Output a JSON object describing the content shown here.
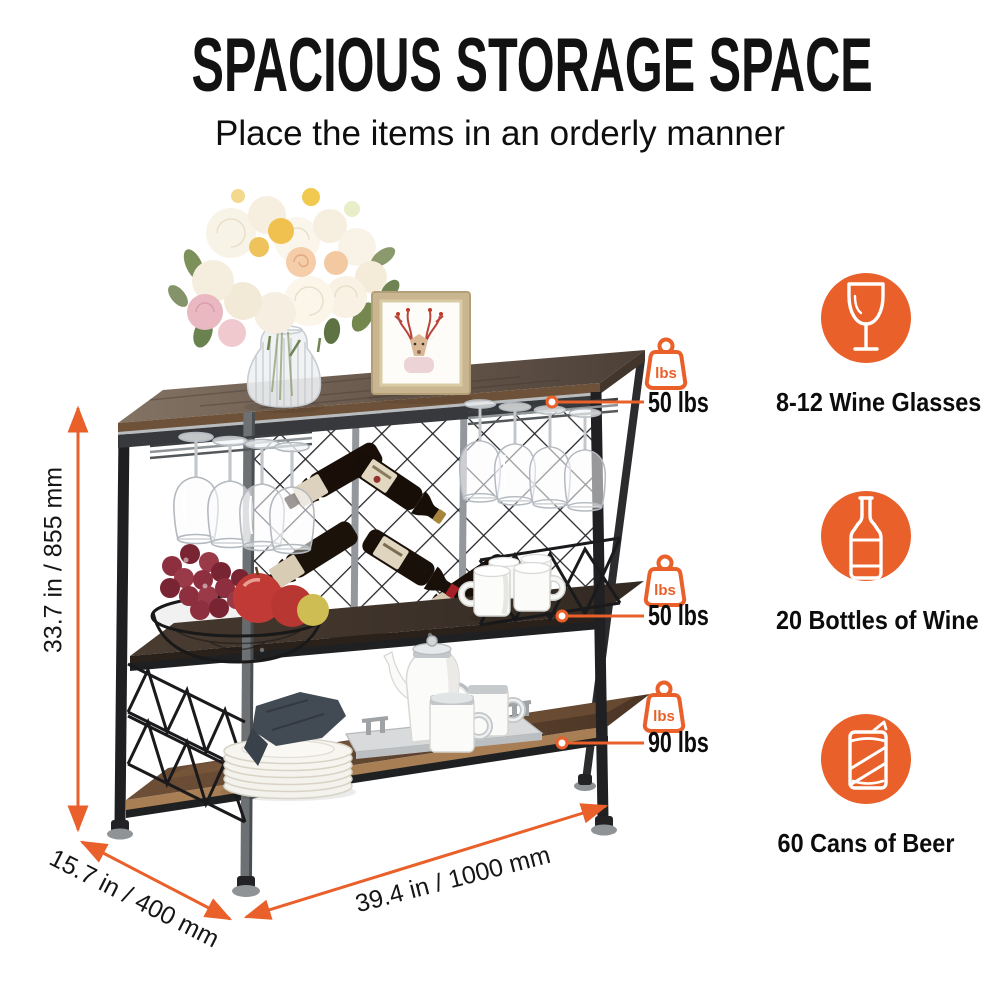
{
  "header": {
    "title": "SPACIOUS STORAGE SPACE",
    "subtitle": "Place the items in an orderly manner"
  },
  "dimensions": {
    "height": "33.7 in / 855 mm",
    "depth": "15.7 in / 400 mm",
    "width": "39.4 in / 1000 mm"
  },
  "capacity_callouts": [
    {
      "icon": "weight-lbs-icon",
      "icon_text": "lbs",
      "label": "50 lbs"
    },
    {
      "icon": "weight-lbs-icon",
      "icon_text": "lbs",
      "label": "50 lbs"
    },
    {
      "icon": "weight-lbs-icon",
      "icon_text": "lbs",
      "label": "90 lbs"
    }
  ],
  "features": [
    {
      "icon": "wine-glass-icon",
      "label": "8-12 Wine Glasses"
    },
    {
      "icon": "wine-bottle-icon",
      "label": "20 Bottles of Wine"
    },
    {
      "icon": "beer-can-icon",
      "label": "60 Cans of Beer"
    }
  ],
  "colors": {
    "accent": "#E9602A",
    "text": "#111111",
    "background": "#FFFFFF"
  }
}
